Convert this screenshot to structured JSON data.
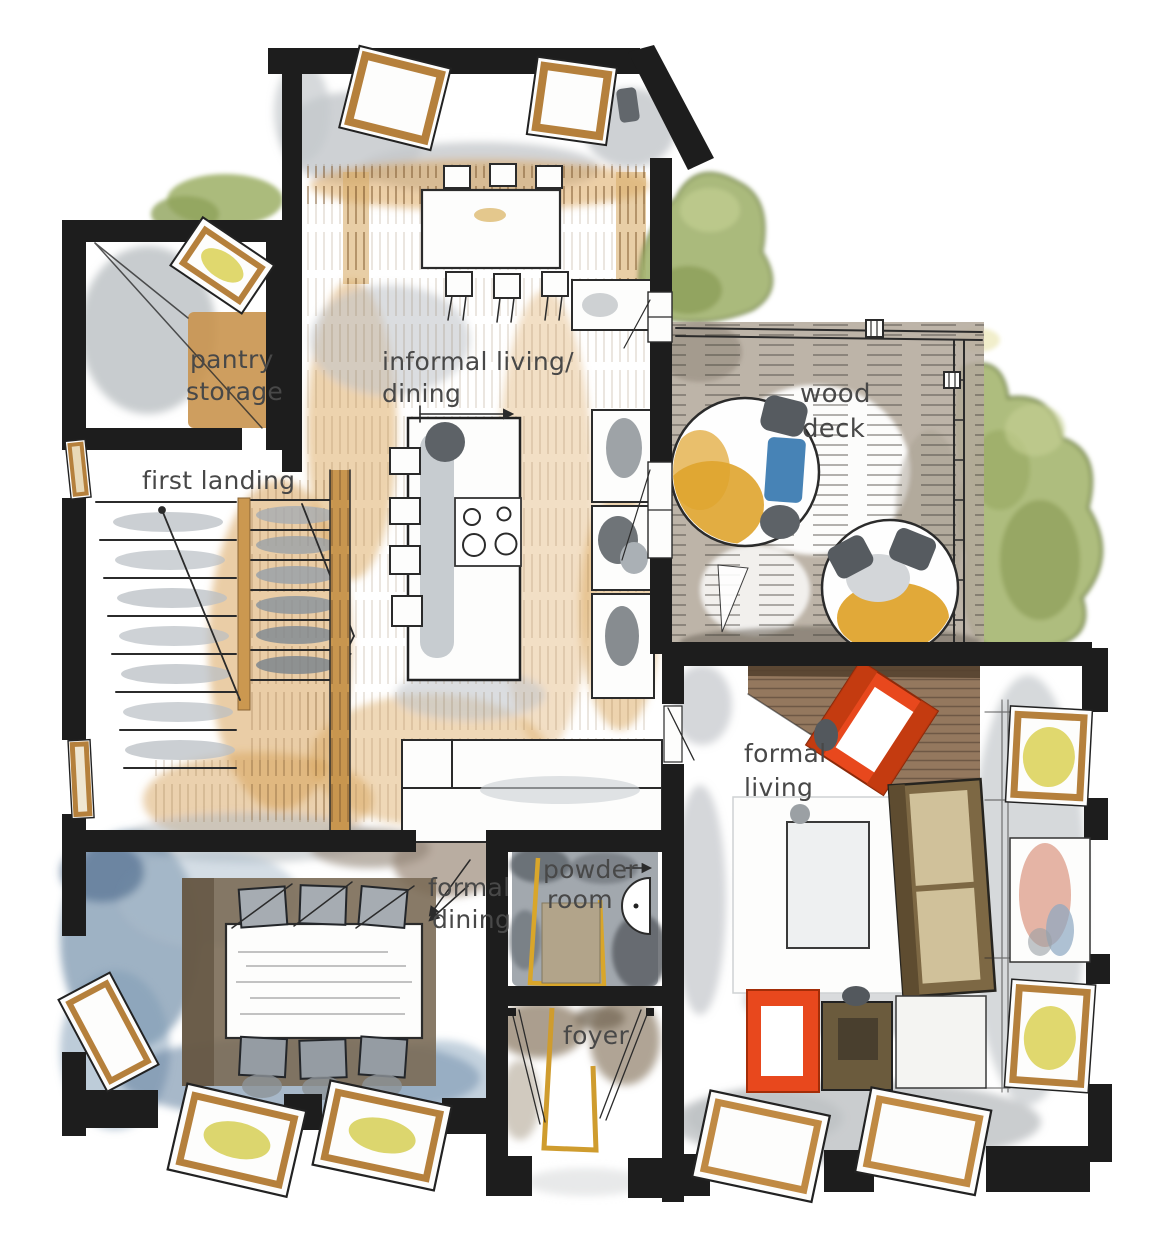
{
  "rooms": {
    "pantry_storage": {
      "label_lines": [
        "pantry",
        "storage"
      ]
    },
    "first_landing": {
      "label_lines": [
        "first landing"
      ]
    },
    "informal_living_dining": {
      "label_lines": [
        "informal living/",
        "dining"
      ]
    },
    "wood_deck": {
      "label_lines": [
        "wood",
        "deck"
      ]
    },
    "formal_living": {
      "label_lines": [
        "formal",
        "living"
      ]
    },
    "formal_dining": {
      "label_lines": [
        "formal",
        "dining"
      ]
    },
    "powder_room": {
      "label_lines": [
        "powder",
        "room"
      ]
    },
    "foyer": {
      "label_lines": [
        "foyer"
      ]
    }
  },
  "palette": {
    "wall_black": "#1d1d1d",
    "wood_tan": "#c8954f",
    "floor_wash_orange": "#dca85e",
    "gray_wash": "#c3c7cb",
    "deck_taupe": "#b4aa9c",
    "blue_floor": "#5e7e9c",
    "accent_chair_orange": "#e8481d",
    "sofa_brown": "#7d6844",
    "window_glass_yellow": "#ddd45e",
    "door_gold": "#cf9c2e",
    "foliage_green": "#a3b571",
    "label_ink": "#484848"
  }
}
